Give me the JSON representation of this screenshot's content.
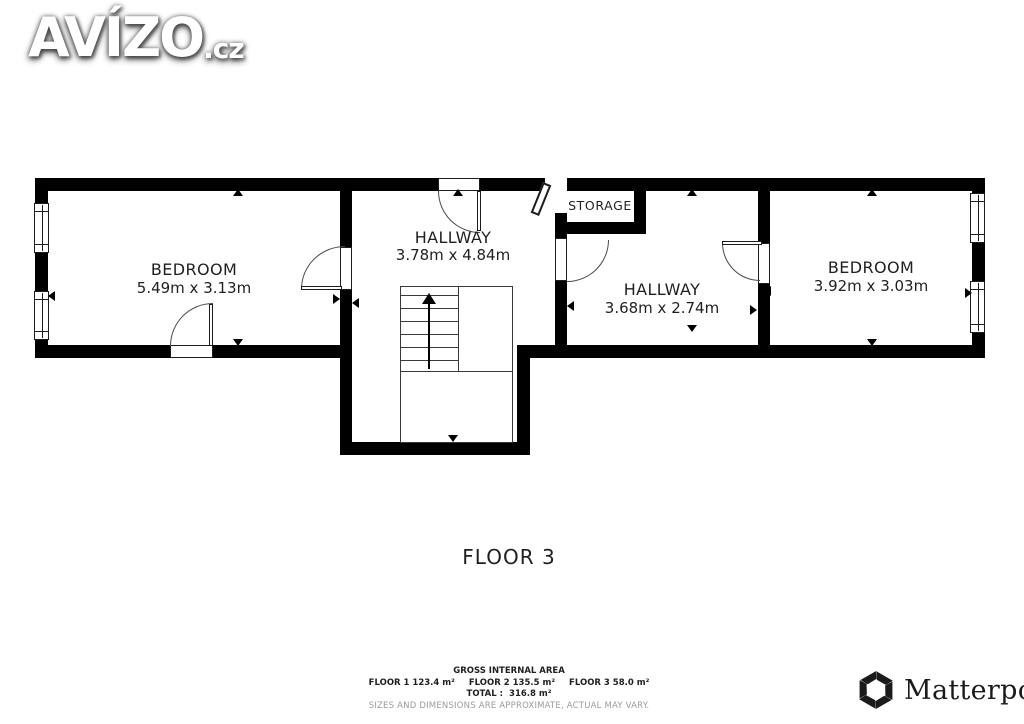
{
  "watermark": {
    "brand": "AVÍZO",
    "suffix": ".cz"
  },
  "floor_title": "FLOOR 3",
  "rooms": [
    {
      "name": "BEDROOM",
      "dimensions": "5.49m x 3.13m"
    },
    {
      "name": "HALLWAY",
      "dimensions": "3.78m x 4.84m"
    },
    {
      "name": "STORAGE",
      "dimensions": ""
    },
    {
      "name": "HALLWAY",
      "dimensions": "3.68m x 2.74m"
    },
    {
      "name": "BEDROOM",
      "dimensions": "3.92m x 3.03m"
    }
  ],
  "footer": {
    "gross_label": "GROSS INTERNAL AREA",
    "floor_areas": [
      "FLOOR 1 123.4 m²",
      "FLOOR 2 135.5 m²",
      "FLOOR 3 58.0 m²"
    ],
    "total_label": "TOTAL :",
    "total_value": "316.8 m²",
    "disclaimer": "SIZES AND DIMENSIONS ARE APPROXIMATE, ACTUAL MAY VARY.",
    "brand": "Matterport",
    "brand_mark": "®"
  },
  "colors": {
    "wall": "#000000",
    "line": "#3a3a3a",
    "background": "#ffffff",
    "text": "#1f1f1f",
    "muted": "#9b9b9b"
  }
}
